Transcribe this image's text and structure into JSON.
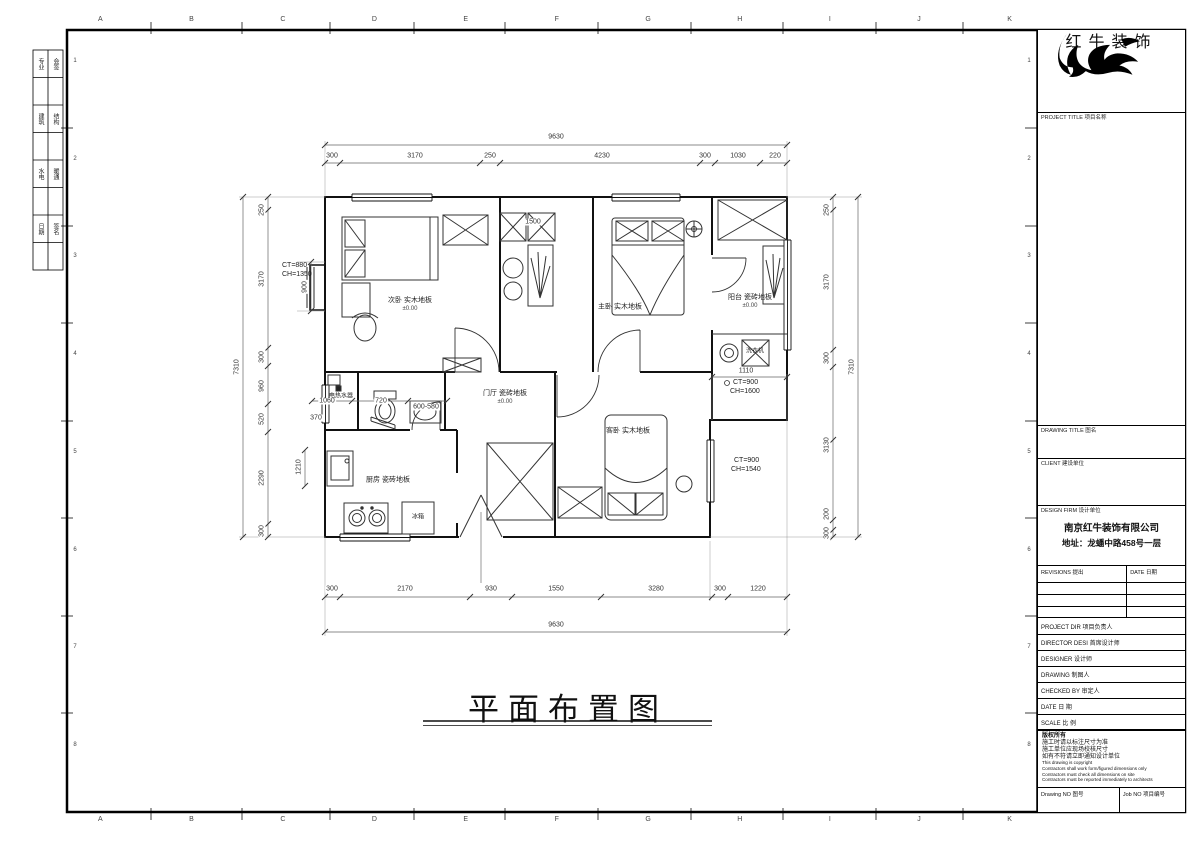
{
  "frame": {
    "cols": [
      "A",
      "B",
      "C",
      "D",
      "E",
      "F",
      "G",
      "H",
      "I",
      "J",
      "K"
    ],
    "rows": [
      "1",
      "2",
      "3",
      "4",
      "5",
      "6",
      "7",
      "8"
    ],
    "sign": [
      "专业",
      "会签",
      "建筑",
      "结构",
      "水电",
      "暖通",
      "日期",
      "签名"
    ]
  },
  "titleblock": {
    "brand": "红牛装饰",
    "project_title_label": "PROJECT TITLE  项目名称",
    "drawing_title_label": "DRAWING TITLE  图名",
    "client_label": "CLIENT  建设单位",
    "design_firm_label": "DESIGN FIRM  设计单位",
    "firm_name": "南京红牛装饰有限公司",
    "firm_address": "地址：龙蟠中路458号一层",
    "revisions_label": "REVISIONS  提出",
    "revisions_date_label": "DATE  日期",
    "rows": [
      "PROJECT DIR   项目负责人",
      "DIRECTOR DESI 首席设计师",
      "DESIGNER      设计师",
      "DRAWING       制图人",
      "CHECKED BY    审定人",
      "DATE          日  期",
      "SCALE         比  例"
    ],
    "copyright": [
      "版权所有",
      "施工时请以标注尺寸为准",
      "施工单位应现场校核尺寸",
      "如有不符请立即通知设计单位",
      "This drawing is copyright",
      "Contractors shall work form/figured dimensions only",
      "Contractors must check all dimensions on site",
      "Contractors must be reported immediately to architects"
    ],
    "drawing_no_label": "Drawing NO  图号",
    "job_no_label": "Job NO  项目编号"
  },
  "plan": {
    "title": "平面布置图",
    "dims": {
      "top_total": "9630",
      "top": [
        "300",
        "3170",
        "250",
        "4230",
        "300",
        "1030",
        "220"
      ],
      "bottom": [
        "300",
        "2170",
        "930",
        "1550",
        "3280",
        "300",
        "1220"
      ],
      "bottom_total": "9630",
      "left": [
        "250",
        "3170",
        "300",
        "960",
        "520",
        "2290",
        "300"
      ],
      "left_total": "7310",
      "right": [
        "250",
        "3170",
        "300",
        "3130",
        "200",
        "300"
      ],
      "right_total": "7310",
      "cabinet": "1500",
      "hall": "1060",
      "toilet": "720",
      "basin": "600-580",
      "balcony": "1110",
      "sink": "1210",
      "bay": "900",
      "step": "370"
    },
    "annotations": {
      "bay_ct": "CT=880",
      "bay_ch": "CH=1350",
      "balc_ct": "CT=900",
      "balc_ch": "CH=1600",
      "win_ct": "CT=900",
      "win_ch": "CH=1540"
    },
    "rooms": {
      "bedroom1": "次卧 实木地板",
      "bedroom1_lvl": "±0.00",
      "master": "主卧 实木地板",
      "balcony": "阳台 瓷砖地板",
      "balcony_lvl": "±0.00",
      "hall": "门厅 瓷砖地板",
      "hall_lvl": "±0.00",
      "kitchen": "厨房 瓷砖地板",
      "bedroom2": "客卧 实木地板",
      "heater": "电热水器",
      "washer": "洗衣机",
      "fridge": "冰箱"
    }
  }
}
